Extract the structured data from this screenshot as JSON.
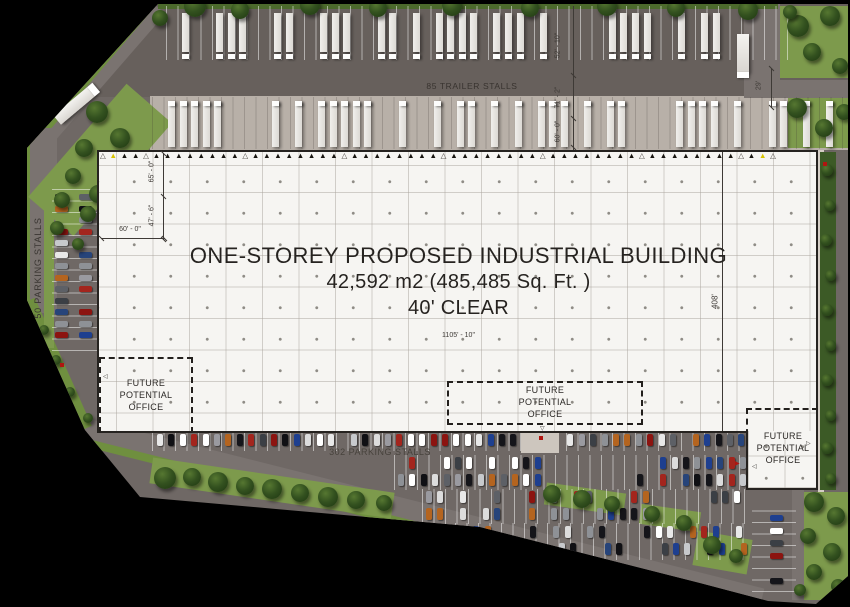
{
  "plan": {
    "building": {
      "title": "ONE-STOREY PROPOSED INDUSTRIAL BUILDING",
      "area": "42,592 m2 (485,485 Sq. Ft. )",
      "clear": "40' CLEAR",
      "width": "1105' - 10\"",
      "depth": "408'"
    },
    "labels": {
      "trailer": "85 TRAILER STALLS",
      "parking_main": "302 PARKING STALLS",
      "parking_west": "50 PARKING STALLS"
    },
    "offices": {
      "west": "FUTURE POTENTIAL OFFICE",
      "south": "FUTURE POTENTIAL OFFICE",
      "east": "FUTURE POTENTIAL OFFICE"
    },
    "dims": {
      "bay_a": "65' - 0\"",
      "bay_b": "47' - 6\"",
      "bay_w": "60' - 0\"",
      "court_a": "52' - 10\"",
      "court_b": "71' - 2\"",
      "court_c": "60' - 0\"",
      "east_drive": "29'"
    },
    "colors": {
      "background": "#000000",
      "asphalt": "#6f6865",
      "truck_court": "#67605c",
      "dock_apron": "#b8b0a8",
      "building_fill": "#f6f5f2",
      "grass": "#7d9a4c",
      "tree": "#2c4a1e",
      "ink": "#262320",
      "accent_red": "#b01510",
      "accent_yellow": "#d8c400"
    }
  }
}
